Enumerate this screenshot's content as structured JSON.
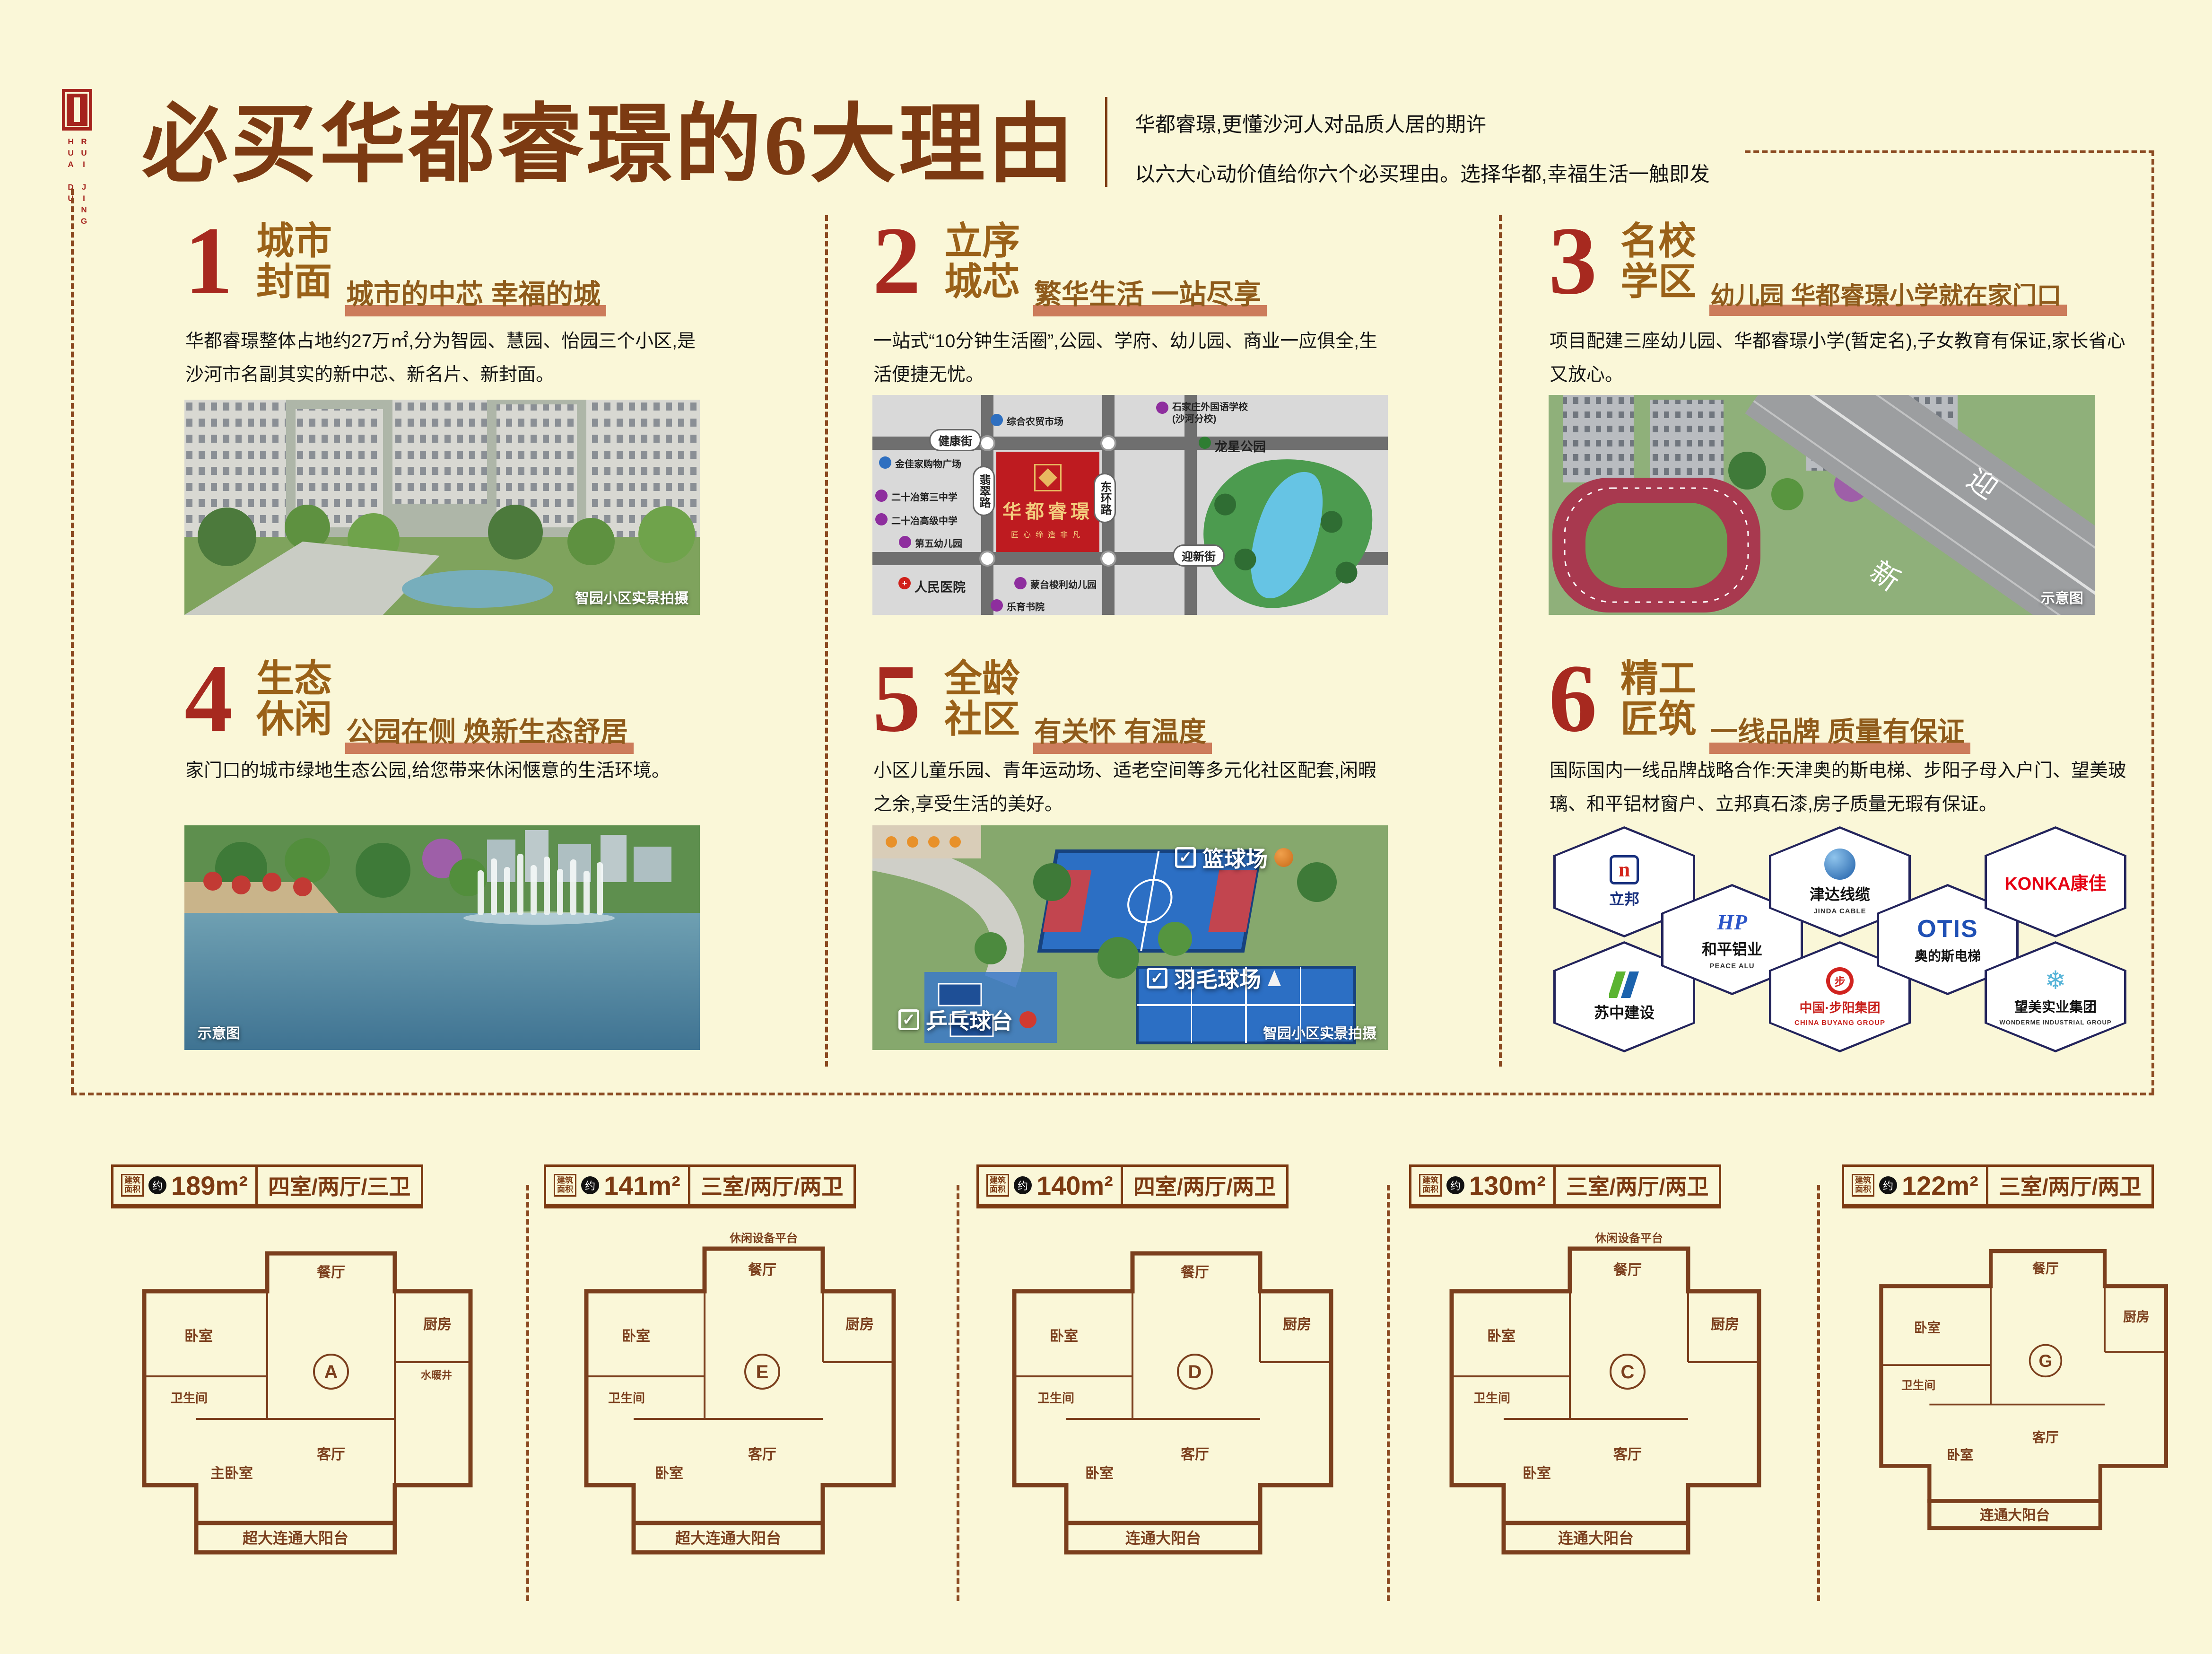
{
  "page": {
    "bg": "#FAF7D8",
    "accent_brown": "#7C3A12",
    "accent_red": "#A7291F",
    "underline_bar": "#CC7C5B"
  },
  "logo": {
    "latin1": "HUA DU",
    "latin2": "RUI JING"
  },
  "header": {
    "title": "必买华都睿璟的6大理由",
    "tagline1": "华都睿璟,更懂沙河人对品质人居的期许",
    "tagline2": "以六大心动价值给你六个必买理由。选择华都,幸福生活一触即发"
  },
  "sections": [
    {
      "num": "1",
      "title1": "城市",
      "title2": "封面",
      "subtitle": "城市的中芯 幸福的城",
      "body": "华都睿璟整体占地约27万㎡,分为智园、慧园、怡园三个小区,是沙河市名副其实的新中芯、新名片、新封面。",
      "caption": "智园小区实景拍摄"
    },
    {
      "num": "2",
      "title1": "立序",
      "title2": "城芯",
      "subtitle": "繁华生活 一站尽享",
      "body": "一站式“10分钟生活圈”,公园、学府、幼儿园、商业一应俱全,生活便捷无忧。"
    },
    {
      "num": "3",
      "title1": "名校",
      "title2": "学区",
      "subtitle": "幼儿园 华都睿璟小学就在家门口",
      "body": "项目配建三座幼儿园、华都睿璟小学(暂定名),子女教育有保证,家长省心又放心。",
      "caption": "示意图"
    },
    {
      "num": "4",
      "title1": "生态",
      "title2": "休闲",
      "subtitle": "公园在侧 焕新生态舒居",
      "body": "家门口的城市绿地生态公园,给您带来休闲惬意的生活环境。",
      "caption": "示意图"
    },
    {
      "num": "5",
      "title1": "全龄",
      "title2": "社区",
      "subtitle": "有关怀 有温度",
      "body": "小区儿童乐园、青年运动场、适老空间等多元化社区配套,闲暇之余,享受生活的美好。",
      "caption": "智园小区实景拍摄",
      "tags": [
        "篮球场",
        "羽毛球场",
        "乒乓球台"
      ]
    },
    {
      "num": "6",
      "title1": "精工",
      "title2": "匠筑",
      "subtitle": "一线品牌 质量有保证",
      "body": "国际国内一线品牌战略合作:天津奥的斯电梯、步阳子母入户门、望美玻璃、和平铝材窗户、立邦真石漆,房子质量无瑕有保证。"
    }
  ],
  "map": {
    "street_top": "健康街",
    "street_bottom": "迎新街",
    "street_left": "翡翠路",
    "street_right": "东环路",
    "project_name": "华都睿璟",
    "project_slogan": "匠心缔造非凡",
    "park_name": "龙星公园",
    "poi_market": "综合农贸市场",
    "poi_school_foreign": "石家庄外国语学校(沙河分校)",
    "poi_mall": "金佳家购物广场",
    "poi_middle3": "二十冶第三中学",
    "poi_highschool": "二十冶高级中学",
    "poi_kindergarten5": "第五幼儿园",
    "poi_hospital": "人民医院",
    "poi_montessori": "蒙台梭利幼儿园",
    "poi_academy": "乐育书院"
  },
  "school_photo": {
    "road_char1": "迎",
    "road_char2": "新"
  },
  "brands": [
    {
      "name": "立邦",
      "sub": ""
    },
    {
      "name": "和平铝业",
      "sub": "PEACE ALU"
    },
    {
      "name": "津达线缆",
      "sub": "JINDA CABLE"
    },
    {
      "name": "OTIS",
      "sub": "奥的斯电梯"
    },
    {
      "name": "KONKA康佳",
      "sub": ""
    },
    {
      "name": "苏中建设",
      "sub": ""
    },
    {
      "name": "中国·步阳集团",
      "sub": "CHINA BUYANG GROUP"
    },
    {
      "name": "望美实业集团",
      "sub": "WONDERME INDUSTRIAL GROUP"
    }
  ],
  "floorplan_common": {
    "area_label1": "建筑",
    "area_label2": "面积",
    "approx": "约"
  },
  "floorplans": [
    {
      "area": "189m²",
      "layout": "四室/两厅/三卫",
      "letter": "A",
      "balcony": "超大连通大阳台",
      "rooms": [
        "卧室",
        "餐厅",
        "厨房",
        "卫生间",
        "客厅",
        "主卧室"
      ],
      "extra": "水暖井"
    },
    {
      "area": "141m²",
      "layout": "三室/两厅/两卫",
      "letter": "E",
      "balcony": "超大连通大阳台",
      "top_label": "休闲设备平台",
      "rooms": [
        "卧室",
        "餐厅",
        "厨房",
        "卫生间",
        "客厅",
        "卧室"
      ]
    },
    {
      "area": "140m²",
      "layout": "四室/两厅/两卫",
      "letter": "D",
      "balcony": "连通大阳台",
      "rooms": [
        "卧室",
        "餐厅",
        "厨房",
        "卫生间",
        "客厅",
        "卧室"
      ]
    },
    {
      "area": "130m²",
      "layout": "三室/两厅/两卫",
      "letter": "C",
      "balcony": "连通大阳台",
      "top_label": "休闲设备平台",
      "rooms": [
        "卧室",
        "餐厅",
        "厨房",
        "卫生间",
        "客厅",
        "卧室"
      ]
    },
    {
      "area": "122m²",
      "layout": "三室/两厅/两卫",
      "letter": "G",
      "balcony": "连通大阳台",
      "rooms": [
        "卧室",
        "餐厅",
        "厨房",
        "卫生间",
        "客厅",
        "卧室"
      ]
    }
  ]
}
